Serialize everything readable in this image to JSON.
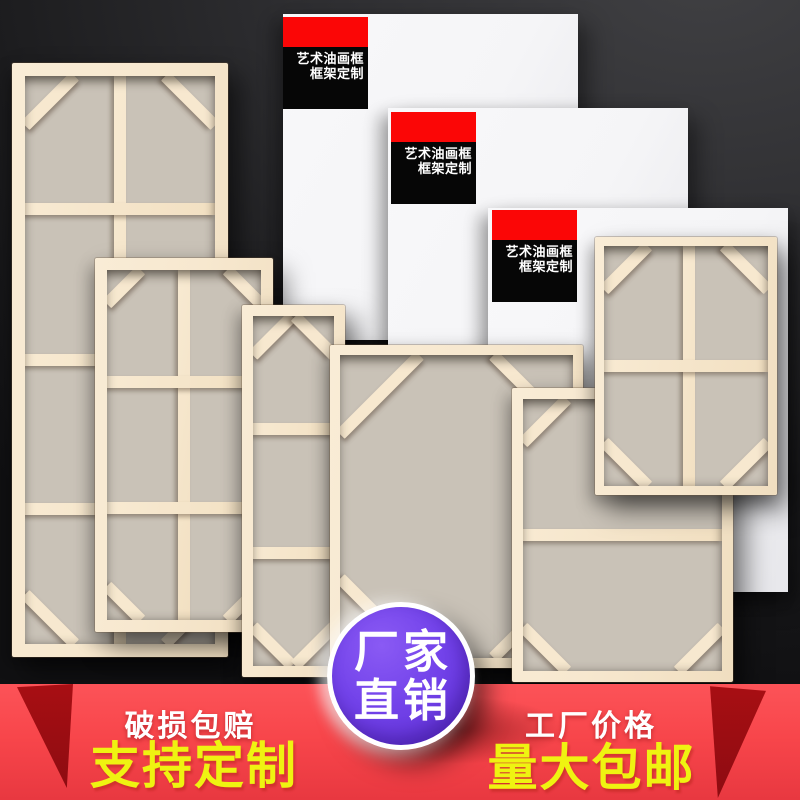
{
  "canvas_label": {
    "line1": "艺术油画框",
    "line2": "框架定制"
  },
  "badge": {
    "line1": "厂家",
    "line2": "直销"
  },
  "ribbon": {
    "left_small": "破损包赔",
    "left_large": "支持定制",
    "right_small": "工厂价格",
    "right_large": "量大包邮"
  },
  "colors": {
    "bg_1": "#404043",
    "bg_2": "#2e2e31",
    "bg_3": "#1b1b1d",
    "bg_4": "#111113",
    "wood": "#f7e8cf",
    "wood_hi": "#f9ecd6",
    "wood_lo": "#f0dec0",
    "canvas_back": "#c9c2b7",
    "panel_white": "#f5f5f7",
    "label_red": "#fb0606",
    "label_black": "#060606",
    "ribbon_red": "#f8464b",
    "ribbon_red_hi": "#fc5358",
    "ribbon_red_lo": "#e83840",
    "ribbon_fold": "#a80e13",
    "ribbon_fold_lo": "#8d0c11",
    "promo_yellow": "#eff311",
    "badge_purple_1": "#8a5af4",
    "badge_purple_2": "#5c2dd2",
    "text_white": "#ffffff"
  },
  "canvases": [
    {
      "x": 283,
      "y": 14,
      "w": 295,
      "h": 326,
      "label_dx": 0,
      "label_dy": 3
    },
    {
      "x": 388,
      "y": 108,
      "w": 300,
      "h": 322,
      "label_dx": 3,
      "label_dy": 4
    },
    {
      "x": 488,
      "y": 208,
      "w": 300,
      "h": 384,
      "label_dx": 4,
      "label_dy": 2
    }
  ],
  "frames": [
    {
      "x": 12,
      "y": 63,
      "w": 216,
      "h": 594,
      "b": 13,
      "v": [
        0.5
      ],
      "h_bars": [
        0.235,
        0.5,
        0.762
      ],
      "brace": 70
    },
    {
      "x": 95,
      "y": 258,
      "w": 178,
      "h": 374,
      "b": 12,
      "v": [
        0.5
      ],
      "h_bars": [
        0.32,
        0.68
      ],
      "brace": 48
    },
    {
      "x": 242,
      "y": 305,
      "w": 103,
      "h": 372,
      "b": 11,
      "v": [],
      "h_bars": [
        0.323,
        0.677
      ],
      "brace": 55
    },
    {
      "x": 330,
      "y": 345,
      "w": 253,
      "h": 323,
      "b": 10,
      "v": [],
      "h_bars": [],
      "brace": 112
    },
    {
      "x": 512,
      "y": 388,
      "w": 221,
      "h": 294,
      "b": 11,
      "v": [],
      "h_bars": [
        0.5
      ],
      "brace": 62
    },
    {
      "x": 595,
      "y": 237,
      "w": 182,
      "h": 258,
      "b": 9,
      "v": [
        0.52
      ],
      "h_bars": [
        0.5
      ],
      "brace": 62
    }
  ]
}
